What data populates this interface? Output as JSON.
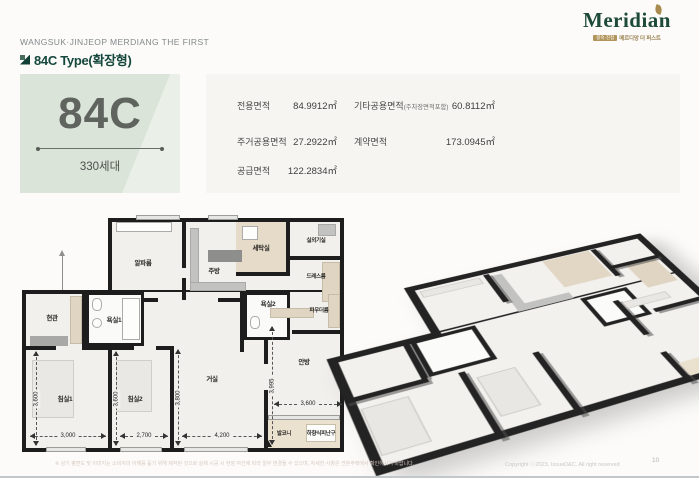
{
  "header": {
    "project_name": "WANGSUK·JINJEOP MERDIANG THE FIRST",
    "unit_title": "84C Type(확장형)"
  },
  "logo": {
    "brand": "Meridian",
    "badge": "왕숙·진접",
    "subtitle": "메르디앙 더 퍼스트"
  },
  "unit_block": {
    "code": "84C",
    "households": "330세대"
  },
  "area_table": {
    "left": [
      {
        "label": "전용면적",
        "value": "84.9912㎡"
      },
      {
        "label": "주거공용면적",
        "value": "27.2922㎡"
      },
      {
        "label": "공급면적",
        "value": "122.2834㎡"
      }
    ],
    "right": [
      {
        "label": "기타공용면적",
        "note": "(주차장면적포함)",
        "value": "60.8112㎡"
      },
      {
        "label": "계약면적",
        "note": "",
        "value": "173.0945㎡"
      }
    ]
  },
  "floor_plan": {
    "rooms": {
      "entrance": "현관",
      "bath1": "욕실1",
      "alpha": "알파룸",
      "kitchen": "주방",
      "laundry": "세탁실",
      "ac_room": "실외기실",
      "dress": "드레스룸",
      "bath2": "욕실2",
      "powder": "파우더룸",
      "bed1": "침실1",
      "bed2": "침실2",
      "living": "거실",
      "master": "안방",
      "balcony": "발코니",
      "escape": "하향식피난구"
    },
    "dims": {
      "bed1_h": "3,600",
      "bed1_w": "3,000",
      "bed2_h": "3,600",
      "bed2_w": "2,700",
      "living_h": "3,800",
      "living_w": "4,200",
      "master_h": "3,995",
      "master_w": "3,600"
    }
  },
  "footer": {
    "disclaimer": "※ 상기 평면도 및 이미지는 소비자의 이해를 돕기 위해 제작된 것으로 실제 시공 시 현장 여건에 따라 일부 변경될 수 있으며, 자세한 사항은 견본주택에서 확인하시기 바랍니다.",
    "copyright": "Copyright ⓒ2023, IssueD&C. All right reserved",
    "page": "10"
  }
}
